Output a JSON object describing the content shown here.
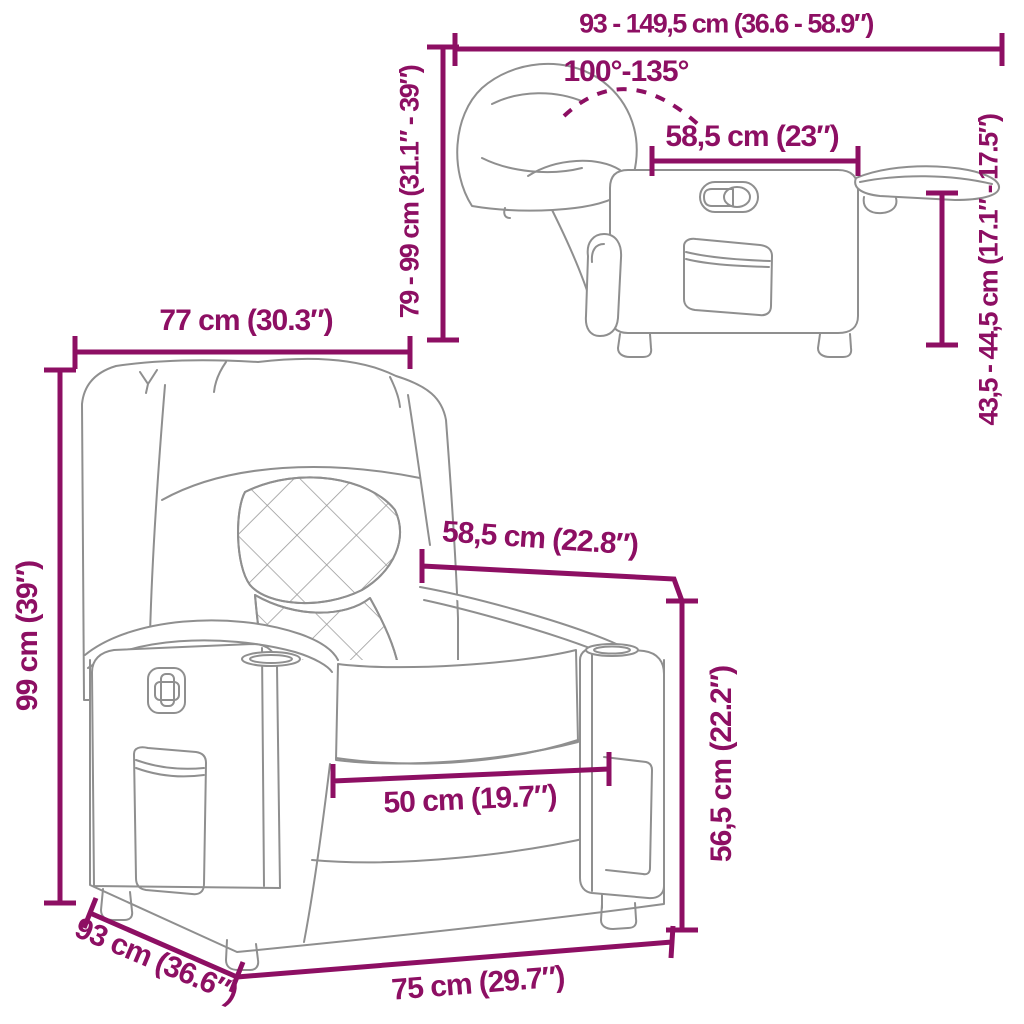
{
  "diagram": {
    "accent_color": "#8D0F63",
    "sketch_color": "#8F8F8F",
    "side_view": {
      "extended_length_label": "93 - 149,5 cm (36.6 - 58.9″)",
      "recline_angle_label": "100°-135°",
      "seat_depth_label": "58,5 cm (23″)",
      "height_range_label": "79 - 99 cm (31.1″ - 39″)",
      "footrest_height_label": "43,5 - 44,5 cm (17.1″ - 17.5″)"
    },
    "front_view": {
      "width_label": "77 cm (30.3″)",
      "height_label": "99 cm (39″)",
      "seat_depth_label": "58,5 cm (22.8″)",
      "seat_height_label": "56,5 cm (22.2″)",
      "seat_width_label": "50 cm (19.7″)",
      "base_width_label": "75 cm (29.7″)",
      "depth_label": "93 cm (36.6″)"
    }
  }
}
